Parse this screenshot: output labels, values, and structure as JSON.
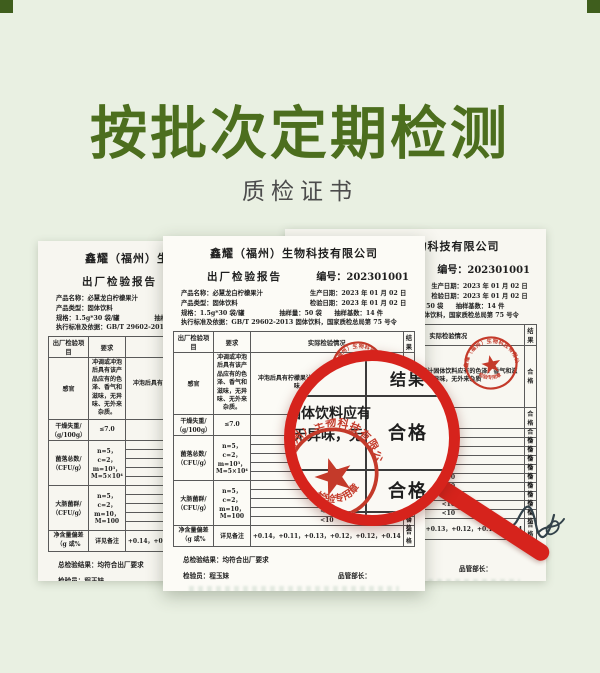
{
  "page": {
    "title": "按批次定期检测",
    "subtitle": "质检证书"
  },
  "colors": {
    "background": "#e9f0e2",
    "title_green": "#4c6e1e",
    "magnifier_red": "#d6231c",
    "stamp_red": "#c43a2a",
    "paper": "#fcfbf6"
  },
  "report": {
    "company": "鑫耀（福州）生物科技有限公司",
    "title": "出厂检验报告",
    "number": "编号：202301001",
    "fields": {
      "product_name": "产品名称：必慧龙白柠檬果汁",
      "product_type": "产品类型：固体饮料",
      "spec": "规格：1.5g*30 袋/罐",
      "sample_qty": "抽样量：50 袋",
      "production_date": "生产日期：2023 年 01 月 02 日",
      "inspection_date": "检验日期：2023 年 01 月 02 日",
      "sample_base": "抽样基数：14 件",
      "standard": "执行标准及依据：GB/T 29602-2013 固体饮料，国家质检总局第 75 号令"
    },
    "table": {
      "headers": [
        "出厂检验项目",
        "要求",
        "实际检验情况",
        "结果"
      ],
      "rows": [
        {
          "item": "感官",
          "requirement": "冲调或冲泡后具有该产品应有的色泽、香气和滋味，无异味、无外来杂质。",
          "actual": "冲泡后具有柠檬果汁固体饮料应有的色泽、香气和滋味，无异味，无外来杂质",
          "result": "合格"
        },
        {
          "item": "干燥失重/（g/100g）",
          "requirement": "≤7.0",
          "actual": "1.8",
          "result": "合格"
        },
        {
          "item": "菌落总数/（CFU/g）",
          "requirement": "n=5，c=2，m=10³，M=5×10⁴",
          "actual_lines": [
            "<10",
            "<10",
            "<10",
            "<10",
            "<10"
          ],
          "result_lines": [
            "合格",
            "合格",
            "合格",
            "合格",
            "合格"
          ]
        },
        {
          "item": "大肠菌群/（CFU/g）",
          "requirement": "n=5，c=2，m=10，M=100",
          "actual_lines": [
            "<10",
            "<10",
            "<10",
            "<10",
            "<10"
          ],
          "result_lines": [
            "合格",
            "合格",
            "合格",
            "合格",
            "合格"
          ]
        },
        {
          "item": "净含量偏差（g 或%",
          "requirement": "详见备注",
          "actual": "+0.14，+0.11，+0.13，+0.12，+0.12，+0.14",
          "result": "合格"
        }
      ]
    },
    "summary": "总检验结果：均符合出厂要求",
    "inspector": "检验员：程玉妹",
    "qa_manager_label": "品管部长：",
    "remark": "备注：净含量 0-50 g 允许短缺量≥-9%；净含量 50-100 g 允许短缺量≥-4.5g；净含量 100-200g 允许短缺量≥-4.5%；200-300 g 允许短缺量≥-9g；300-500 g 允许短缺量≥-3%；500-1000g 允许短缺量≥-15g。"
  },
  "magnifier": {
    "header": "结果",
    "zoom_line1": "固体饮料应有",
    "zoom_line2": "无异味，无",
    "pass1": "合格",
    "pass2": "合格",
    "pass3": "合格"
  },
  "stamp": {
    "arc_text": "鑫耀（福州）生物科技有限公司",
    "bottom_text": "检验专用章"
  }
}
